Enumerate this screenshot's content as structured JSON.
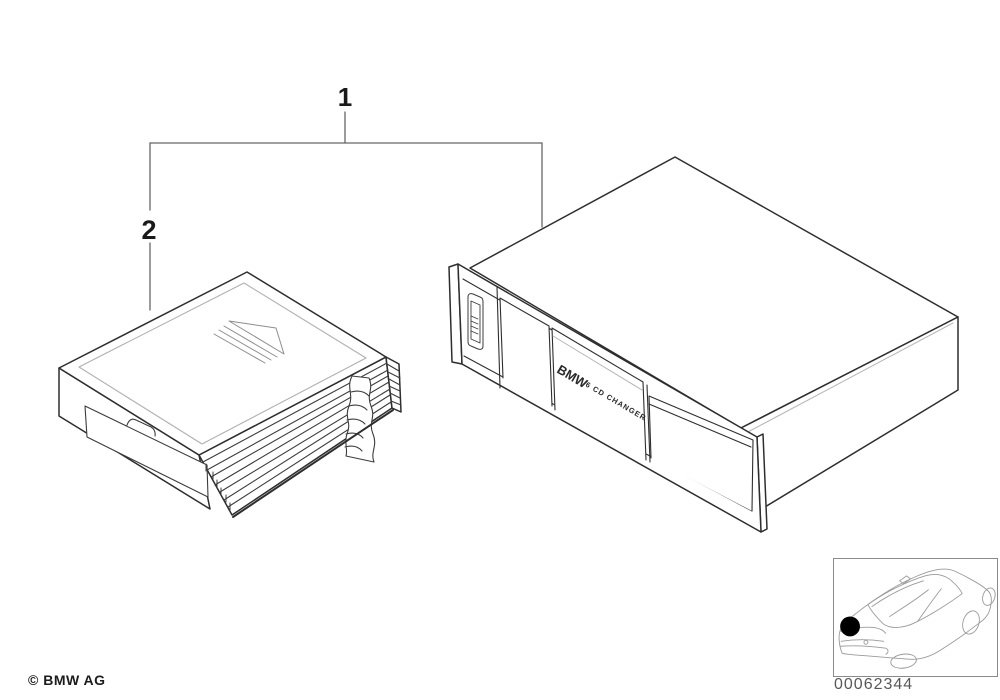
{
  "diagram": {
    "title_hint": "BMW CD changer parts illustration",
    "callout_1": "1",
    "callout_2": "2",
    "changer_label": {
      "brand": "BMW",
      "model": "6 CD CHANGER"
    }
  },
  "footer": {
    "copyright": "© BMW AG"
  },
  "reference": {
    "part_number": "00062344"
  },
  "colors": {
    "line_dark": "#2e2e2e",
    "line_medium": "#3c3c3c",
    "line_light": "#b5b5b5",
    "bracket_line": "#666666",
    "text_dark": "#1a1a1a",
    "part_number_text": "#585858",
    "location_dot": "#000000",
    "background": "#ffffff"
  }
}
